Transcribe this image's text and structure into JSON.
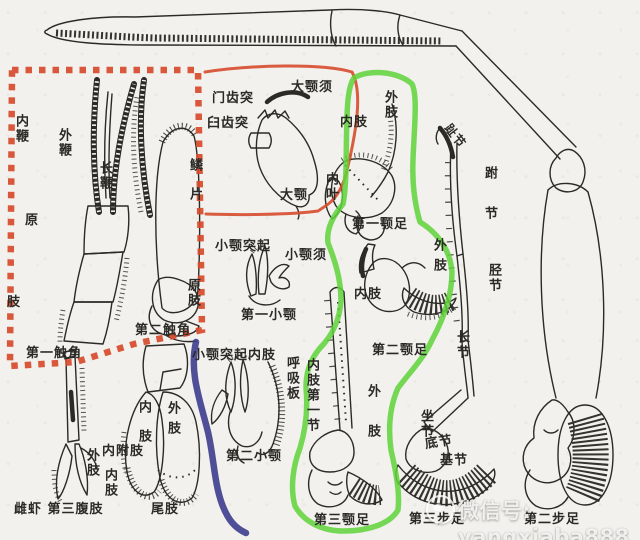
{
  "colors": {
    "paper": "#f2f1ed",
    "ink": "#2b2a26",
    "red_outline": "#d74b2c",
    "green_outline": "#5fd33a",
    "blue_outline": "#3d3d8d",
    "watermark": "#ffffff"
  },
  "labels": {
    "inner_flagellum": "内鞭",
    "outer_flagellum": "外鞭",
    "long_flagellum": "长鞭",
    "scale": "鳞片",
    "protopod_a1": "原",
    "protopod_a2": "肢",
    "first_antenna": "第一触角",
    "second_antenna": "第二触角",
    "protopod_b": "原肢",
    "incisor_process": "门齿突",
    "molar_process": "臼齿突",
    "mandibular_palp": "大颚须",
    "mandible": "大颚",
    "maxilla_process": "小颚突起",
    "maxilla_palp": "小颚须",
    "first_maxilla": "第一小颚",
    "maxilla_process_endopod": "小颚突起内肢",
    "respiratory_plate": "呼吸板",
    "second_maxilla": "第二小颚",
    "mxp1_endopod": "内肢",
    "inner_lobe": "内叶",
    "mxp1_exopod": "外肢",
    "first_maxilliped": "第一颚足",
    "mxp2_endopod": "内肢",
    "mxp2_exopod": "外肢",
    "second_maxilliped": "第二颚足",
    "endopod_first_segment": "内肢第一节",
    "mxp3_exopod": "外肢",
    "third_maxilliped": "第三颚足",
    "pleopod_exopod": "外肢",
    "inner_appendage": "内附肢",
    "pleopod_endopod": "内肢",
    "female_third_pleopod": "雌虾 第三腹肢",
    "uropod_endopod": "内肢",
    "uropod_exopod": "外肢",
    "uropod": "尾肢",
    "dactylus": "趾节",
    "tarsus": "跗节",
    "tibia": "胫节",
    "merus": "长节",
    "ischium": "坐节",
    "coxa": "底节",
    "basis": "基节",
    "third_pereopod": "第三步足",
    "second_pereopod": "第二步足"
  },
  "watermark": {
    "text": "微信号: yangxiaba888"
  }
}
